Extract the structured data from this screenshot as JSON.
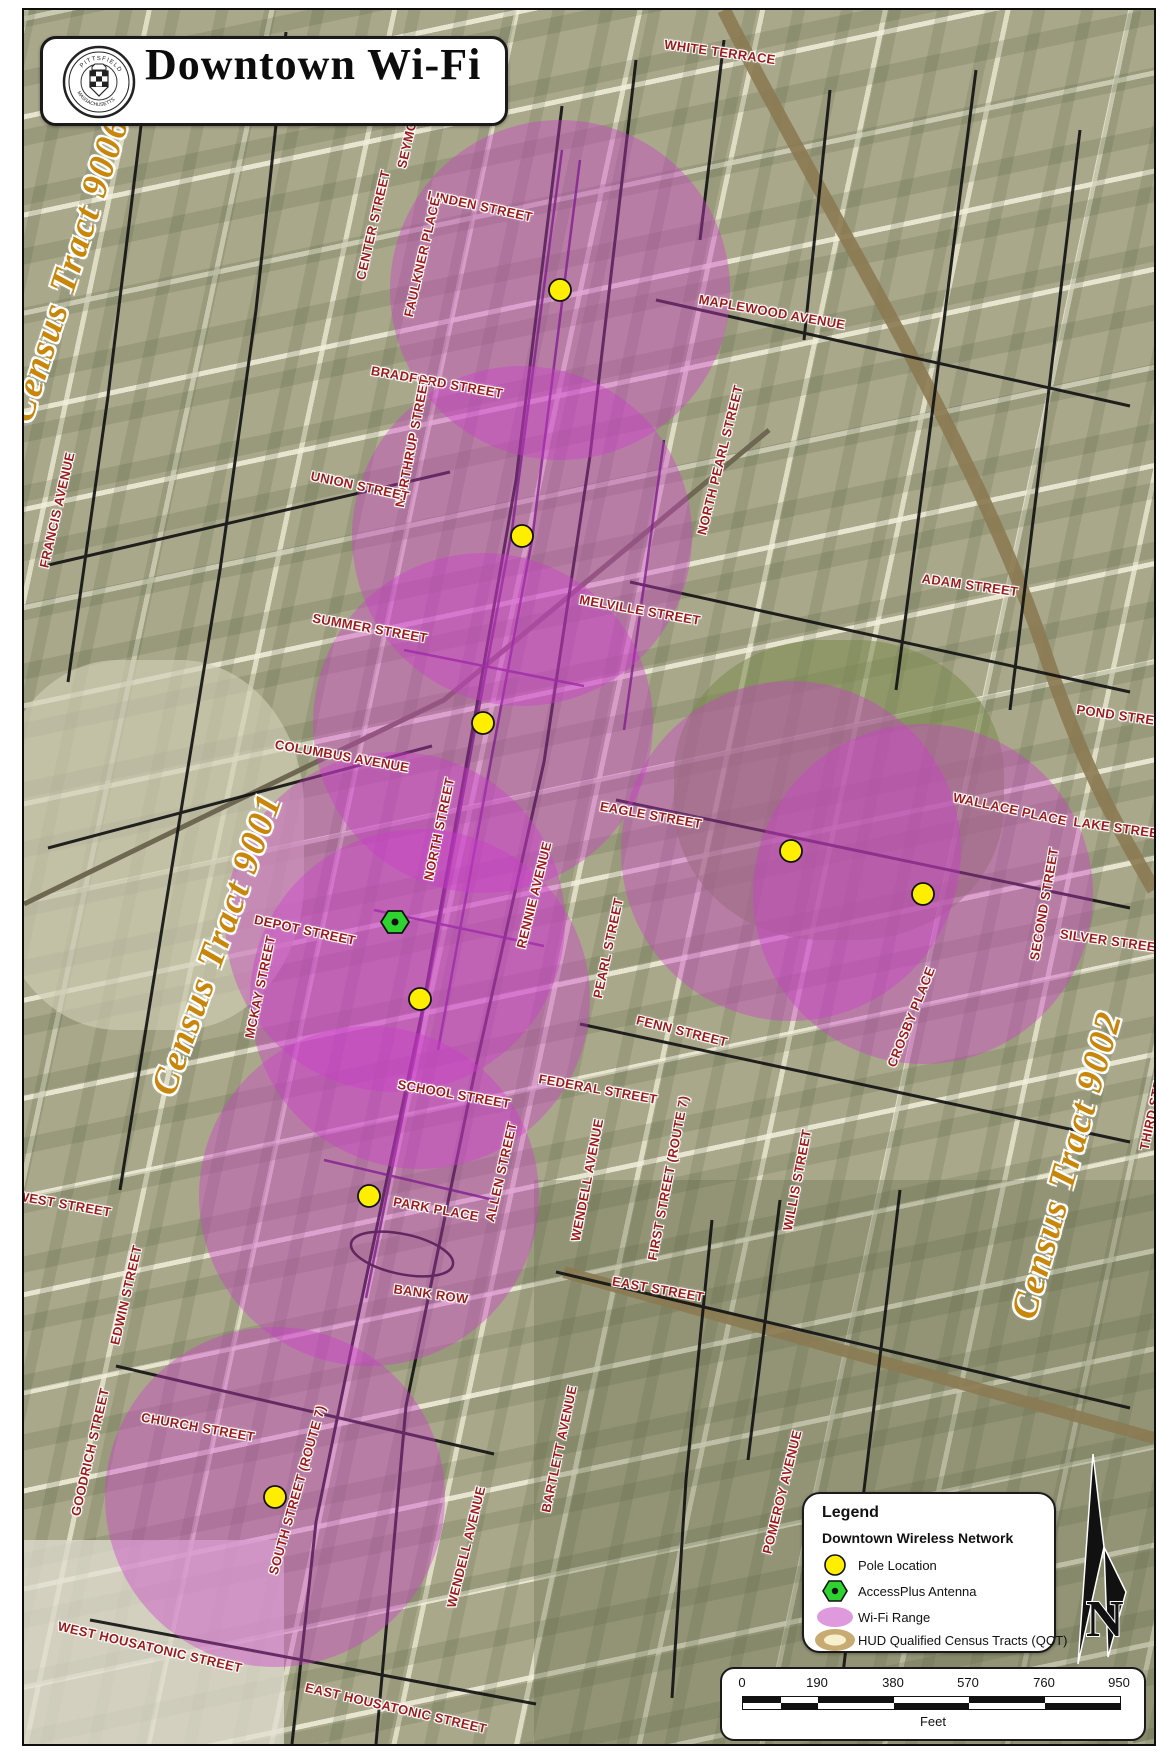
{
  "header": {
    "title": "Downtown Wi-Fi"
  },
  "seal": {
    "ring_top": "PITTSFIELD",
    "ring_bottom": "MASSACHUSETTS"
  },
  "census_labels": [
    {
      "t": "Census Tract 9006",
      "x": 67,
      "y": 267,
      "r": -72
    },
    {
      "t": "Census Tract 9001",
      "x": 215,
      "y": 942,
      "r": -70
    },
    {
      "t": "Census Tract 9002",
      "x": 1065,
      "y": 1163,
      "r": -74
    }
  ],
  "street_labels": [
    {
      "t": "WHITE TERRACE",
      "x": 718,
      "y": 50,
      "r": 8
    },
    {
      "t": "SEYMOUR",
      "x": 407,
      "y": 133,
      "r": -77
    },
    {
      "t": "LINDEN STREET",
      "x": 478,
      "y": 204,
      "r": 12
    },
    {
      "t": "CENTER STREET",
      "x": 371,
      "y": 223,
      "r": -77
    },
    {
      "t": "FAULKNER PLACE",
      "x": 420,
      "y": 255,
      "r": -77
    },
    {
      "t": "MAPLEWOOD AVENUE",
      "x": 770,
      "y": 310,
      "r": 10
    },
    {
      "t": "BRADFORD STREET",
      "x": 435,
      "y": 380,
      "r": 10
    },
    {
      "t": "NORTHRUP STREET",
      "x": 410,
      "y": 440,
      "r": -79
    },
    {
      "t": "NORTH PEARL STREET",
      "x": 718,
      "y": 458,
      "r": -76
    },
    {
      "t": "UNION STREET",
      "x": 358,
      "y": 484,
      "r": 12
    },
    {
      "t": "FRANCIS AVENUE",
      "x": 55,
      "y": 508,
      "r": -77
    },
    {
      "t": "ADAM STREET",
      "x": 968,
      "y": 583,
      "r": 8
    },
    {
      "t": "MELVILLE STREET",
      "x": 638,
      "y": 608,
      "r": 10
    },
    {
      "t": "SUMMER STREET",
      "x": 368,
      "y": 626,
      "r": 10
    },
    {
      "t": "POND STREET",
      "x": 1122,
      "y": 714,
      "r": 8
    },
    {
      "t": "COLUMBUS AVENUE",
      "x": 340,
      "y": 754,
      "r": 10
    },
    {
      "t": "WALLACE PLACE",
      "x": 1008,
      "y": 807,
      "r": 12
    },
    {
      "t": "EAGLE STREET",
      "x": 649,
      "y": 813,
      "r": 10
    },
    {
      "t": "LAKE STREET",
      "x": 1118,
      "y": 826,
      "r": 8
    },
    {
      "t": "NORTH STREET",
      "x": 437,
      "y": 827,
      "r": -78
    },
    {
      "t": "RENNIE AVENUE",
      "x": 532,
      "y": 893,
      "r": -76
    },
    {
      "t": "SECOND STREET",
      "x": 1042,
      "y": 902,
      "r": -80
    },
    {
      "t": "DEPOT STREET",
      "x": 303,
      "y": 928,
      "r": 12
    },
    {
      "t": "SILVER STREET",
      "x": 1110,
      "y": 939,
      "r": 8
    },
    {
      "t": "PEARL STREET",
      "x": 606,
      "y": 946,
      "r": -78
    },
    {
      "t": "MCKAY STREET",
      "x": 258,
      "y": 985,
      "r": -78
    },
    {
      "t": "CROSBY PLACE",
      "x": 909,
      "y": 1015,
      "r": -68
    },
    {
      "t": "FENN STREET",
      "x": 680,
      "y": 1029,
      "r": 14
    },
    {
      "t": "FEDERAL STREET",
      "x": 596,
      "y": 1087,
      "r": 10
    },
    {
      "t": "SCHOOL STREET",
      "x": 452,
      "y": 1092,
      "r": 10
    },
    {
      "t": "THIRD STREET",
      "x": 1152,
      "y": 1100,
      "r": -78
    },
    {
      "t": "ALLEN STREET",
      "x": 499,
      "y": 1170,
      "r": -77
    },
    {
      "t": "FIRST STREET (ROUTE 7)",
      "x": 666,
      "y": 1176,
      "r": -79
    },
    {
      "t": "WENDELL AVENUE",
      "x": 585,
      "y": 1178,
      "r": -79
    },
    {
      "t": "WILLIS STREET",
      "x": 795,
      "y": 1178,
      "r": -79
    },
    {
      "t": "WEST STREET",
      "x": 62,
      "y": 1202,
      "r": 10
    },
    {
      "t": "PARK PLACE",
      "x": 434,
      "y": 1207,
      "r": 10
    },
    {
      "t": "EAST STREET",
      "x": 656,
      "y": 1287,
      "r": 10
    },
    {
      "t": "BANK ROW",
      "x": 429,
      "y": 1292,
      "r": 8
    },
    {
      "t": "EDWIN STREET",
      "x": 124,
      "y": 1293,
      "r": -77
    },
    {
      "t": "CHURCH STREET",
      "x": 196,
      "y": 1425,
      "r": 10
    },
    {
      "t": "BARTLETT AVENUE",
      "x": 557,
      "y": 1447,
      "r": -78
    },
    {
      "t": "GOODRICH STREET",
      "x": 88,
      "y": 1450,
      "r": -77
    },
    {
      "t": "SOUTH STREET (ROUTE 7)",
      "x": 295,
      "y": 1488,
      "r": -74
    },
    {
      "t": "POMEROY AVENUE",
      "x": 780,
      "y": 1490,
      "r": -76
    },
    {
      "t": "WENDELL AVENUE",
      "x": 464,
      "y": 1545,
      "r": -76
    },
    {
      "t": "WEST HOUSATONIC STREET",
      "x": 148,
      "y": 1645,
      "r": 13
    },
    {
      "t": "EAST HOUSATONIC STREET",
      "x": 394,
      "y": 1706,
      "r": 13
    }
  ],
  "poles": [
    {
      "x": 558,
      "y": 288
    },
    {
      "x": 520,
      "y": 534
    },
    {
      "x": 481,
      "y": 721
    },
    {
      "x": 789,
      "y": 849
    },
    {
      "x": 921,
      "y": 892
    },
    {
      "x": 418,
      "y": 997
    },
    {
      "x": 367,
      "y": 1194
    },
    {
      "x": 273,
      "y": 1495
    }
  ],
  "antenna": {
    "x": 393,
    "y": 920
  },
  "wifi_ranges": [
    {
      "cx": 558,
      "cy": 288,
      "r": 170
    },
    {
      "cx": 520,
      "cy": 534,
      "r": 170
    },
    {
      "cx": 481,
      "cy": 721,
      "r": 170
    },
    {
      "cx": 789,
      "cy": 849,
      "r": 170
    },
    {
      "cx": 921,
      "cy": 892,
      "r": 170
    },
    {
      "cx": 418,
      "cy": 997,
      "r": 170
    },
    {
      "cx": 393,
      "cy": 920,
      "r": 170
    },
    {
      "cx": 367,
      "cy": 1194,
      "r": 170
    },
    {
      "cx": 273,
      "cy": 1495,
      "r": 170
    }
  ],
  "legend": {
    "header": "Legend",
    "subheader": "Downtown Wireless Network",
    "items": [
      {
        "label": "Pole Location"
      },
      {
        "label": "AccessPlus Antenna"
      },
      {
        "label": "Wi-Fi Range"
      },
      {
        "label": "HUD Qualified Census Tracts (QCT)"
      }
    ]
  },
  "scalebar": {
    "ticks": [
      "0",
      "190",
      "380",
      "570",
      "760",
      "950"
    ],
    "unit": "Feet"
  },
  "north": {
    "label": "N"
  },
  "colors": {
    "street_label": "#9b1b1b",
    "census_label": "#c8860b",
    "wifi_fill": "rgba(204,60,204,0.40)",
    "pole_fill": "#ffee00",
    "antenna_fill": "#2fd32f"
  }
}
